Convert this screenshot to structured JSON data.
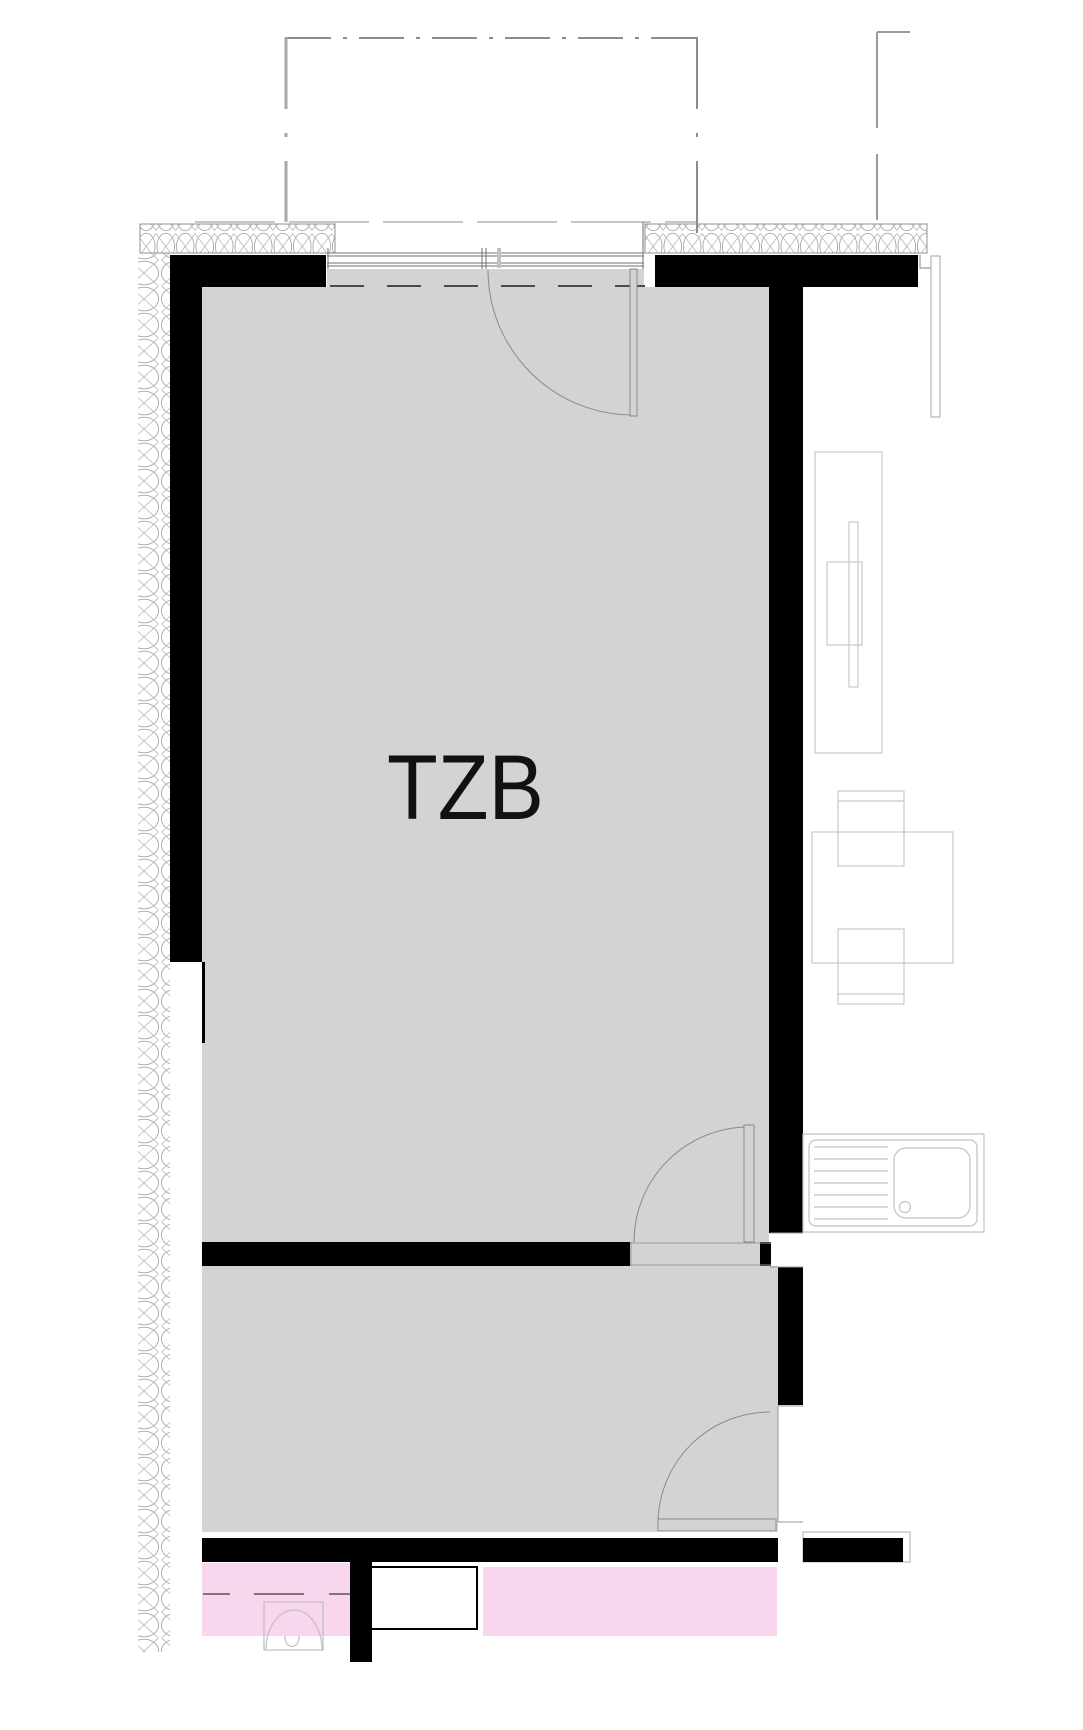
{
  "plan": {
    "room_label": "TZB"
  },
  "colors": {
    "wall": "#000000",
    "room_fill": "#d3d3d3",
    "accent_pink": "#f8d6ee",
    "line_gray": "#9b9b9b",
    "furniture_gray": "#c9c9c9",
    "fixture_gray": "#c2c2c2",
    "door_arc_gray": "#8a8a8a",
    "label_text": "#111111"
  }
}
